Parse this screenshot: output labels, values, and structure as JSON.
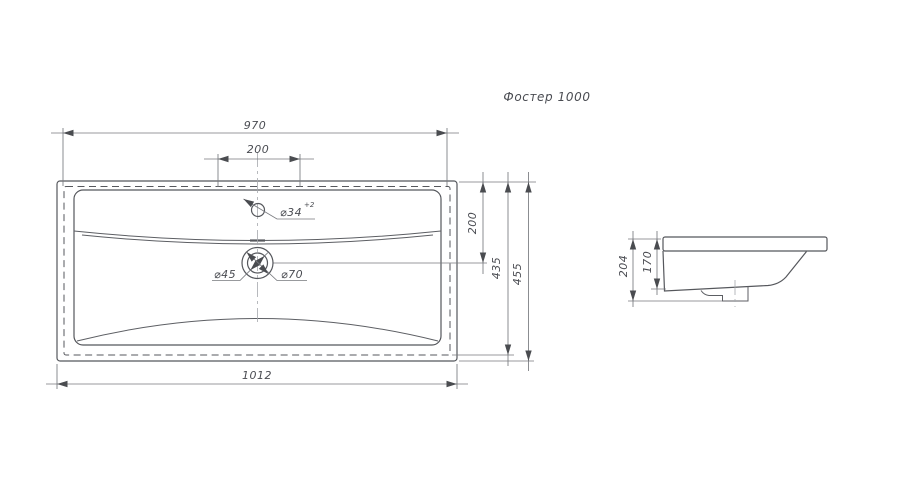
{
  "title": "Фостер 1000",
  "front_view": {
    "dim_width_top": "970",
    "dim_faucet_span": "200",
    "dim_width_overall": "1012",
    "dim_drain_depth": "200",
    "dim_height_inner": "435",
    "dim_height_overall": "455",
    "faucet_hole_label": "⌀34",
    "faucet_hole_tolerance": "+2",
    "drain_inner_label": "⌀45",
    "drain_outer_label": "⌀70"
  },
  "side_view": {
    "dim_height_total": "204",
    "dim_height_front": "170"
  },
  "colors": {
    "line": "#55575c",
    "dimension": "#77797e",
    "text": "#4a4c52",
    "background": "#ffffff"
  }
}
